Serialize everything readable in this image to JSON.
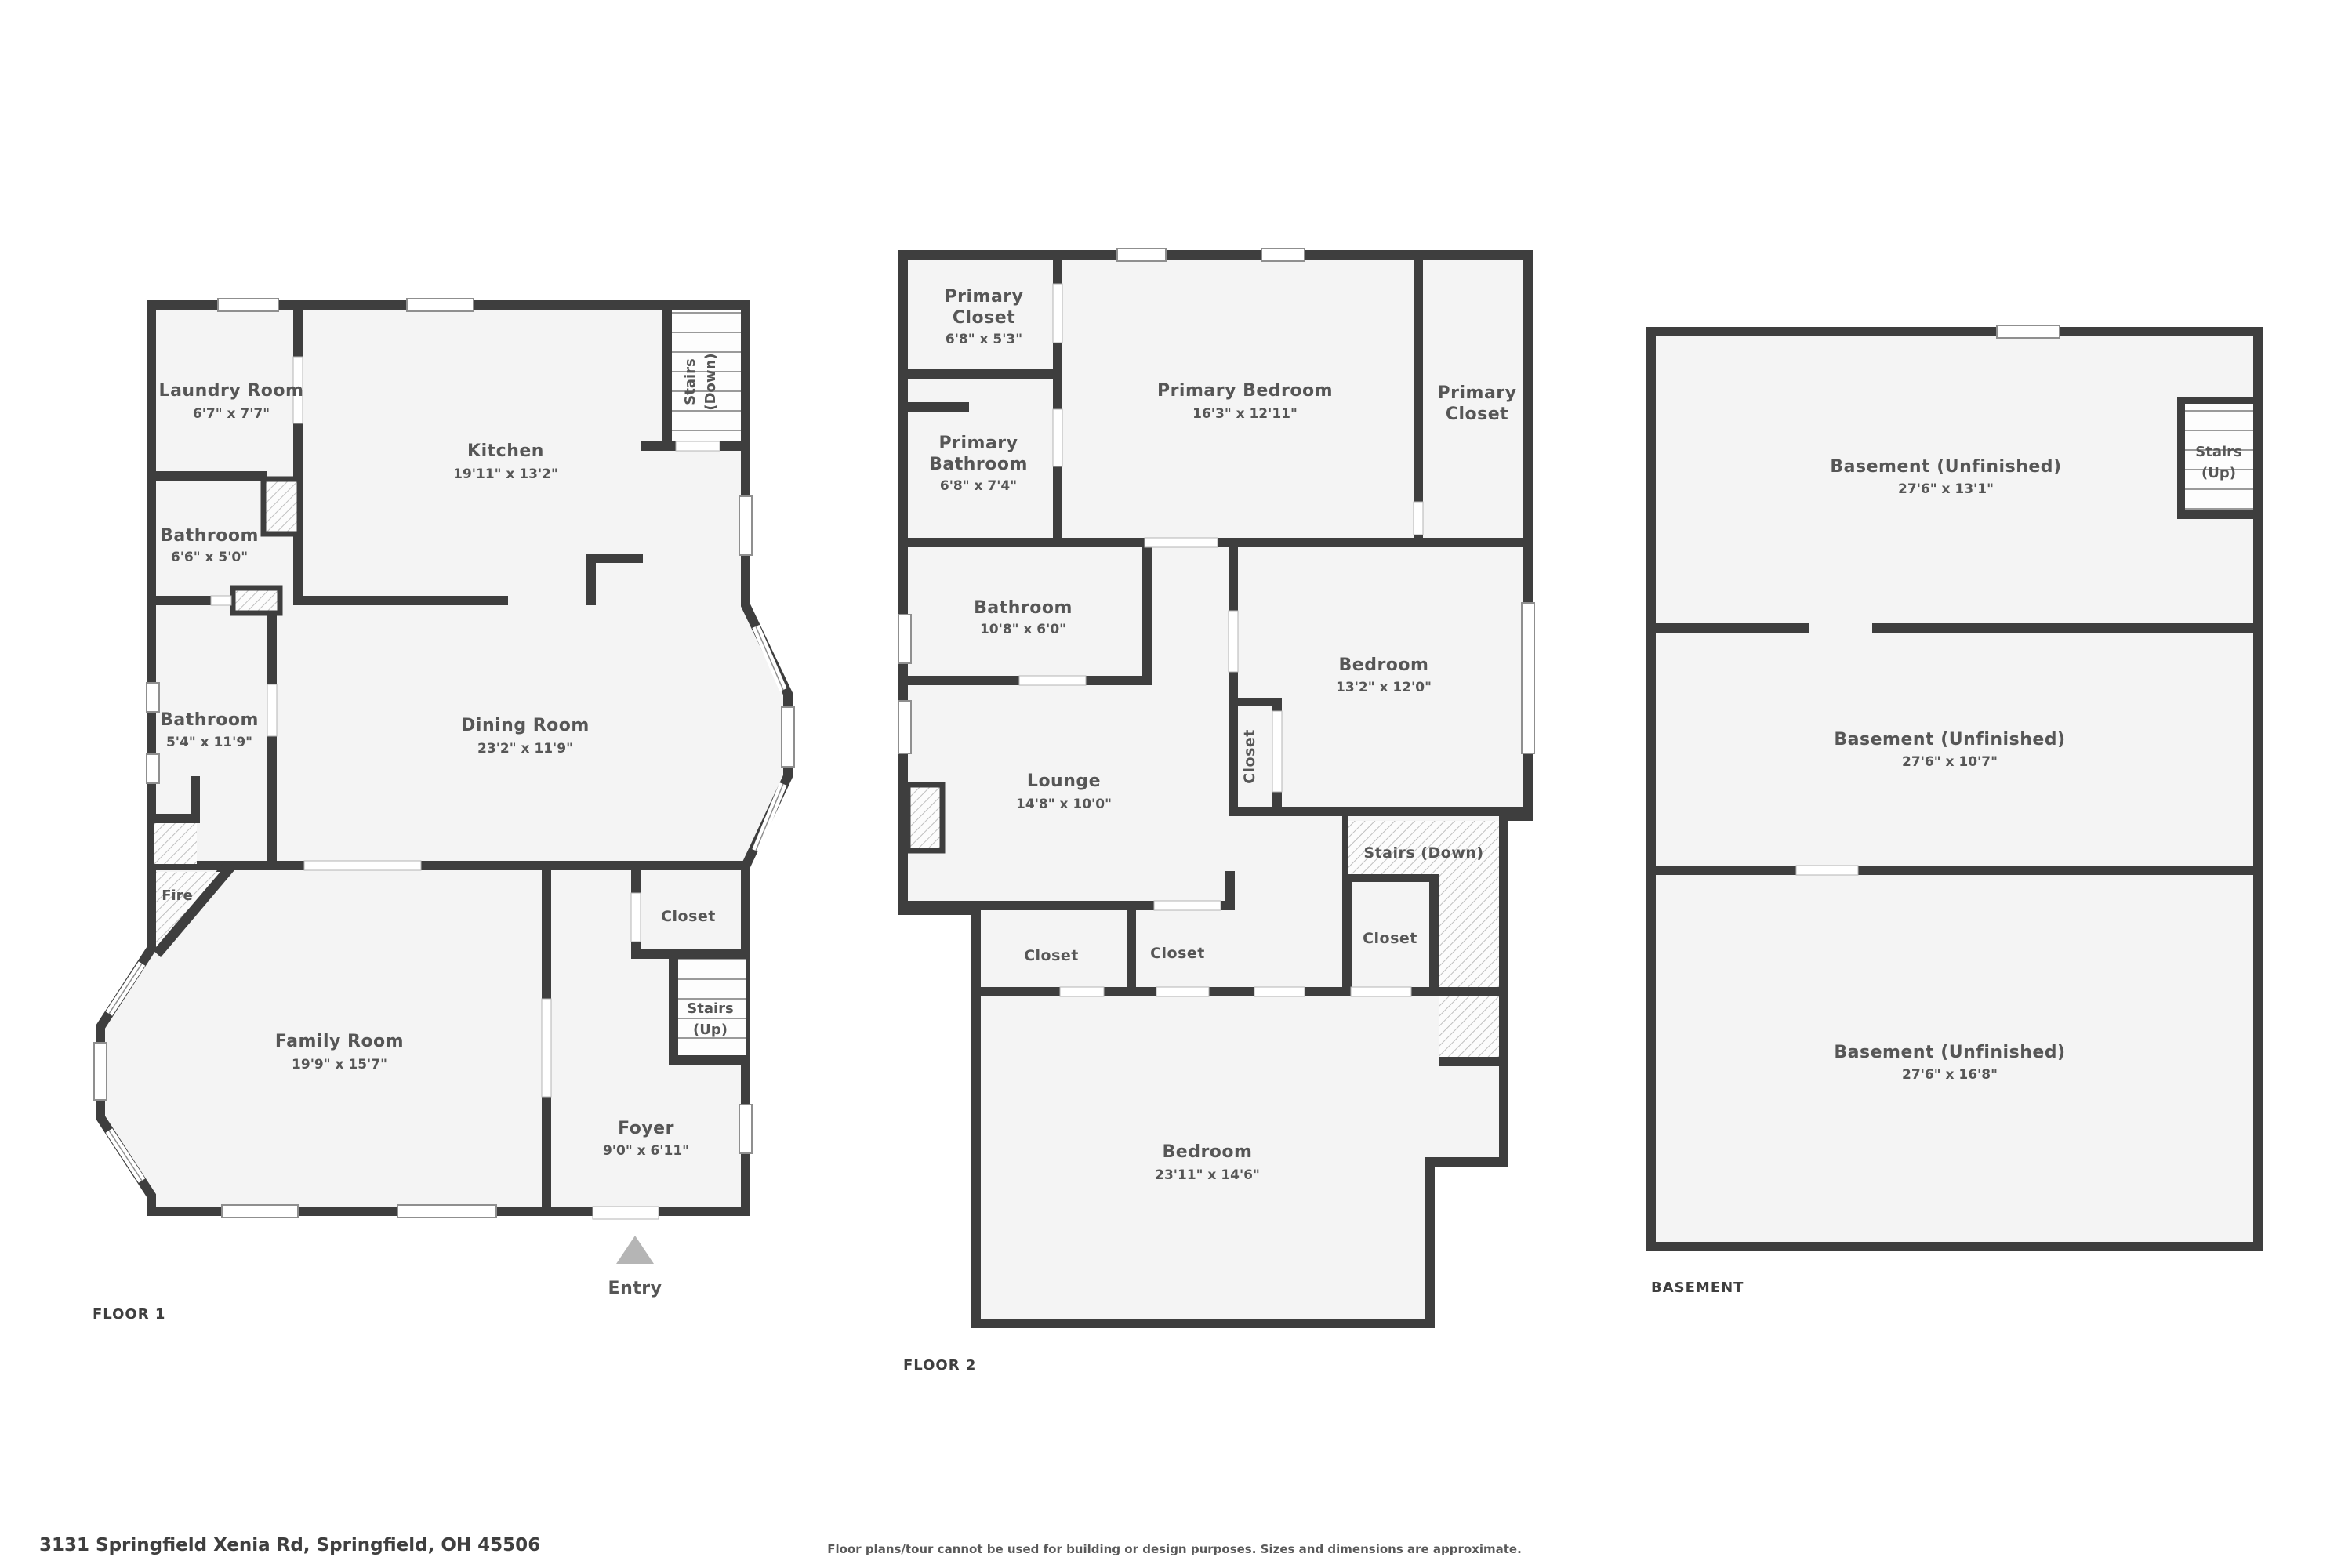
{
  "meta": {
    "address": "3131 Springfield Xenia Rd, Springfield, OH 45506",
    "disclaimer": "Floor plans/tour cannot be used for building or design purposes. Sizes and dimensions are approximate."
  },
  "floor1": {
    "label": "FLOOR 1",
    "rooms": {
      "laundry": {
        "name": "Laundry Room",
        "dims": "6'7\" x 7'7\""
      },
      "kitchen": {
        "name": "Kitchen",
        "dims": "19'11\" x 13'2\""
      },
      "bathroom_small": {
        "name": "Bathroom",
        "dims": "6'6\" x 5'0\""
      },
      "bathroom_long": {
        "name": "Bathroom",
        "dims": "5'4\" x 11'9\""
      },
      "dining_room": {
        "name": "Dining Room",
        "dims": "23'2\" x 11'9\""
      },
      "family_room": {
        "name": "Family Room",
        "dims": "19'9\" x 15'7\""
      },
      "foyer": {
        "name": "Foyer",
        "dims": "9'0\" x 6'11\""
      },
      "closet": {
        "name": "Closet"
      },
      "fireplace": {
        "name": "Fire"
      },
      "stairs_down": {
        "line1": "Stairs",
        "line2": "(Down)"
      },
      "stairs_up": {
        "line1": "Stairs",
        "line2": "(Up)"
      },
      "entry": {
        "name": "Entry"
      }
    }
  },
  "floor2": {
    "label": "FLOOR 2",
    "rooms": {
      "primary_closet_left": {
        "line1": "Primary",
        "line2": "Closet",
        "dims": "6'8\" x 5'3\""
      },
      "primary_bathroom": {
        "line1": "Primary",
        "line2": "Bathroom",
        "dims": "6'8\" x 7'4\""
      },
      "primary_bedroom": {
        "name": "Primary Bedroom",
        "dims": "16'3\" x 12'11\""
      },
      "primary_closet_right": {
        "line1": "Primary",
        "line2": "Closet"
      },
      "bathroom": {
        "name": "Bathroom",
        "dims": "10'8\" x 6'0\""
      },
      "bedroom": {
        "name": "Bedroom",
        "dims": "13'2\" x 12'0\""
      },
      "closet_side": {
        "name": "Closet"
      },
      "lounge": {
        "name": "Lounge",
        "dims": "14'8\" x 10'0\""
      },
      "stairs_down": {
        "name": "Stairs (Down)"
      },
      "closet_a": {
        "name": "Closet"
      },
      "closet_b": {
        "name": "Closet"
      },
      "closet_c": {
        "name": "Closet"
      },
      "bedroom_large": {
        "name": "Bedroom",
        "dims": "23'11\" x 14'6\""
      }
    }
  },
  "basement": {
    "label": "BASEMENT",
    "rooms": {
      "room_top": {
        "name": "Basement (Unfinished)",
        "dims": "27'6\" x 13'1\""
      },
      "room_mid": {
        "name": "Basement (Unfinished)",
        "dims": "27'6\" x 10'7\""
      },
      "room_bottom": {
        "name": "Basement (Unfinished)",
        "dims": "27'6\" x 16'8\""
      },
      "stairs_up": {
        "line1": "Stairs",
        "line2": "(Up)"
      }
    }
  }
}
